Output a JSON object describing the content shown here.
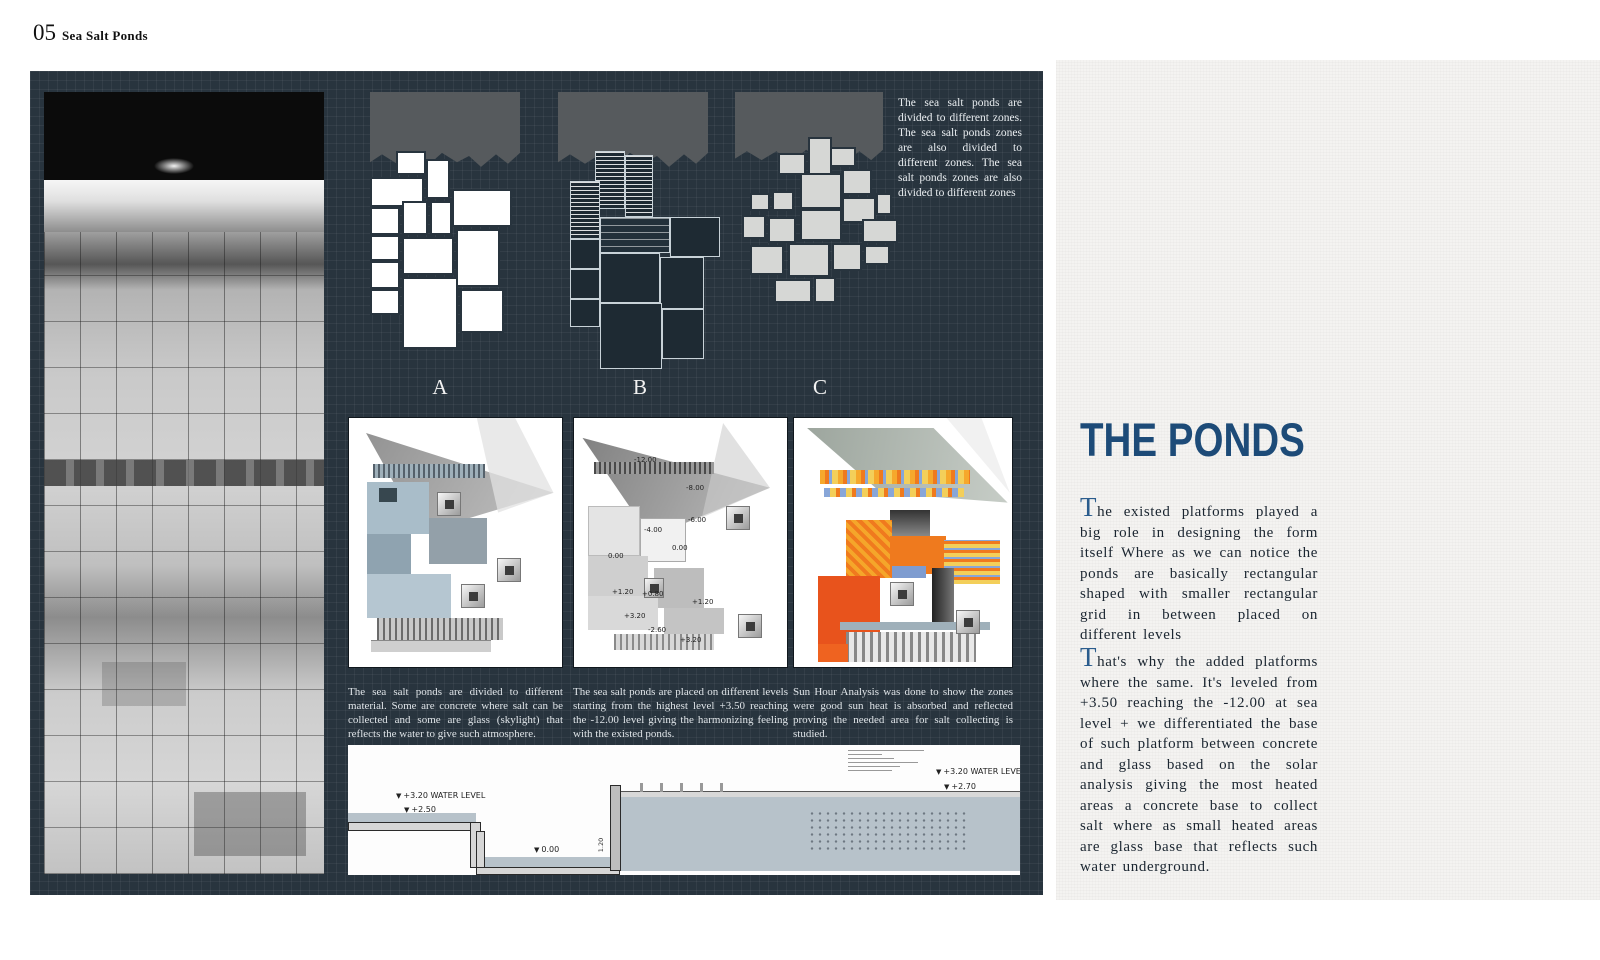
{
  "header": {
    "number": "05",
    "title": "Sea Salt Ponds"
  },
  "board": {
    "zones_paragraph": "The sea salt ponds are divided to different zones. The sea salt ponds zones are also divided to different zones. The sea salt ponds zones are also divided to different zones",
    "diagram_labels": [
      "A",
      "B",
      "C"
    ],
    "captions": [
      "The sea salt ponds are divided to different material. Some are concrete where salt can be collected and some are glass (skylight) that reflects the water to give such atmosphere.",
      "The sea salt ponds are placed on different levels starting from the highest level +3.50 reaching the -12.00 level giving the harmonizing feeling with the existed ponds.",
      "Sun Hour Analysis was done to show the zones were good sun heat is absorbed and reflected proving the needed area for salt collecting is studied."
    ],
    "levels": [
      "-12.00",
      "-8.00",
      "-6.00",
      "-4.00",
      "0.00",
      "0.00",
      "+1.20",
      "+0.80",
      "+1.20",
      "+3.20",
      "-2.60",
      "+3.20"
    ],
    "section": {
      "left_water_label": "+3.20 WATER LEVEL",
      "left_level": "+2.50",
      "mid_level": "0.00",
      "right_water_label": "+3.20 WATER LEVEL",
      "right_level": "+2.70",
      "dim_a": "1.20",
      "dim_b": "1.20"
    }
  },
  "article": {
    "title": "THE PONDS",
    "para1": {
      "cap": "T",
      "text": "he existed platforms played a big role in designing the form itself Where as we can notice the ponds are basically rectangular shaped with smaller rectangular grid in between placed on different levels"
    },
    "para2": {
      "cap": "T",
      "text": "hat's why the added platforms where the same. It's leveled from +3.50 reaching the -12.00 at sea level + we differentiated the base of such platform between concrete and glass based on the solar analysis giving the most heated areas a concrete base to collect salt where as small heated areas are glass base that reflects such water underground."
    }
  },
  "colors": {
    "board_bg": "#28343e",
    "accent_blue": "#1d4b78",
    "water": "#b7c2ca",
    "sun_orange": "#ef7a1e",
    "sun_red": "#e8531c",
    "sun_yellow": "#f3cf5a",
    "sun_blue": "#7e9cd0"
  }
}
